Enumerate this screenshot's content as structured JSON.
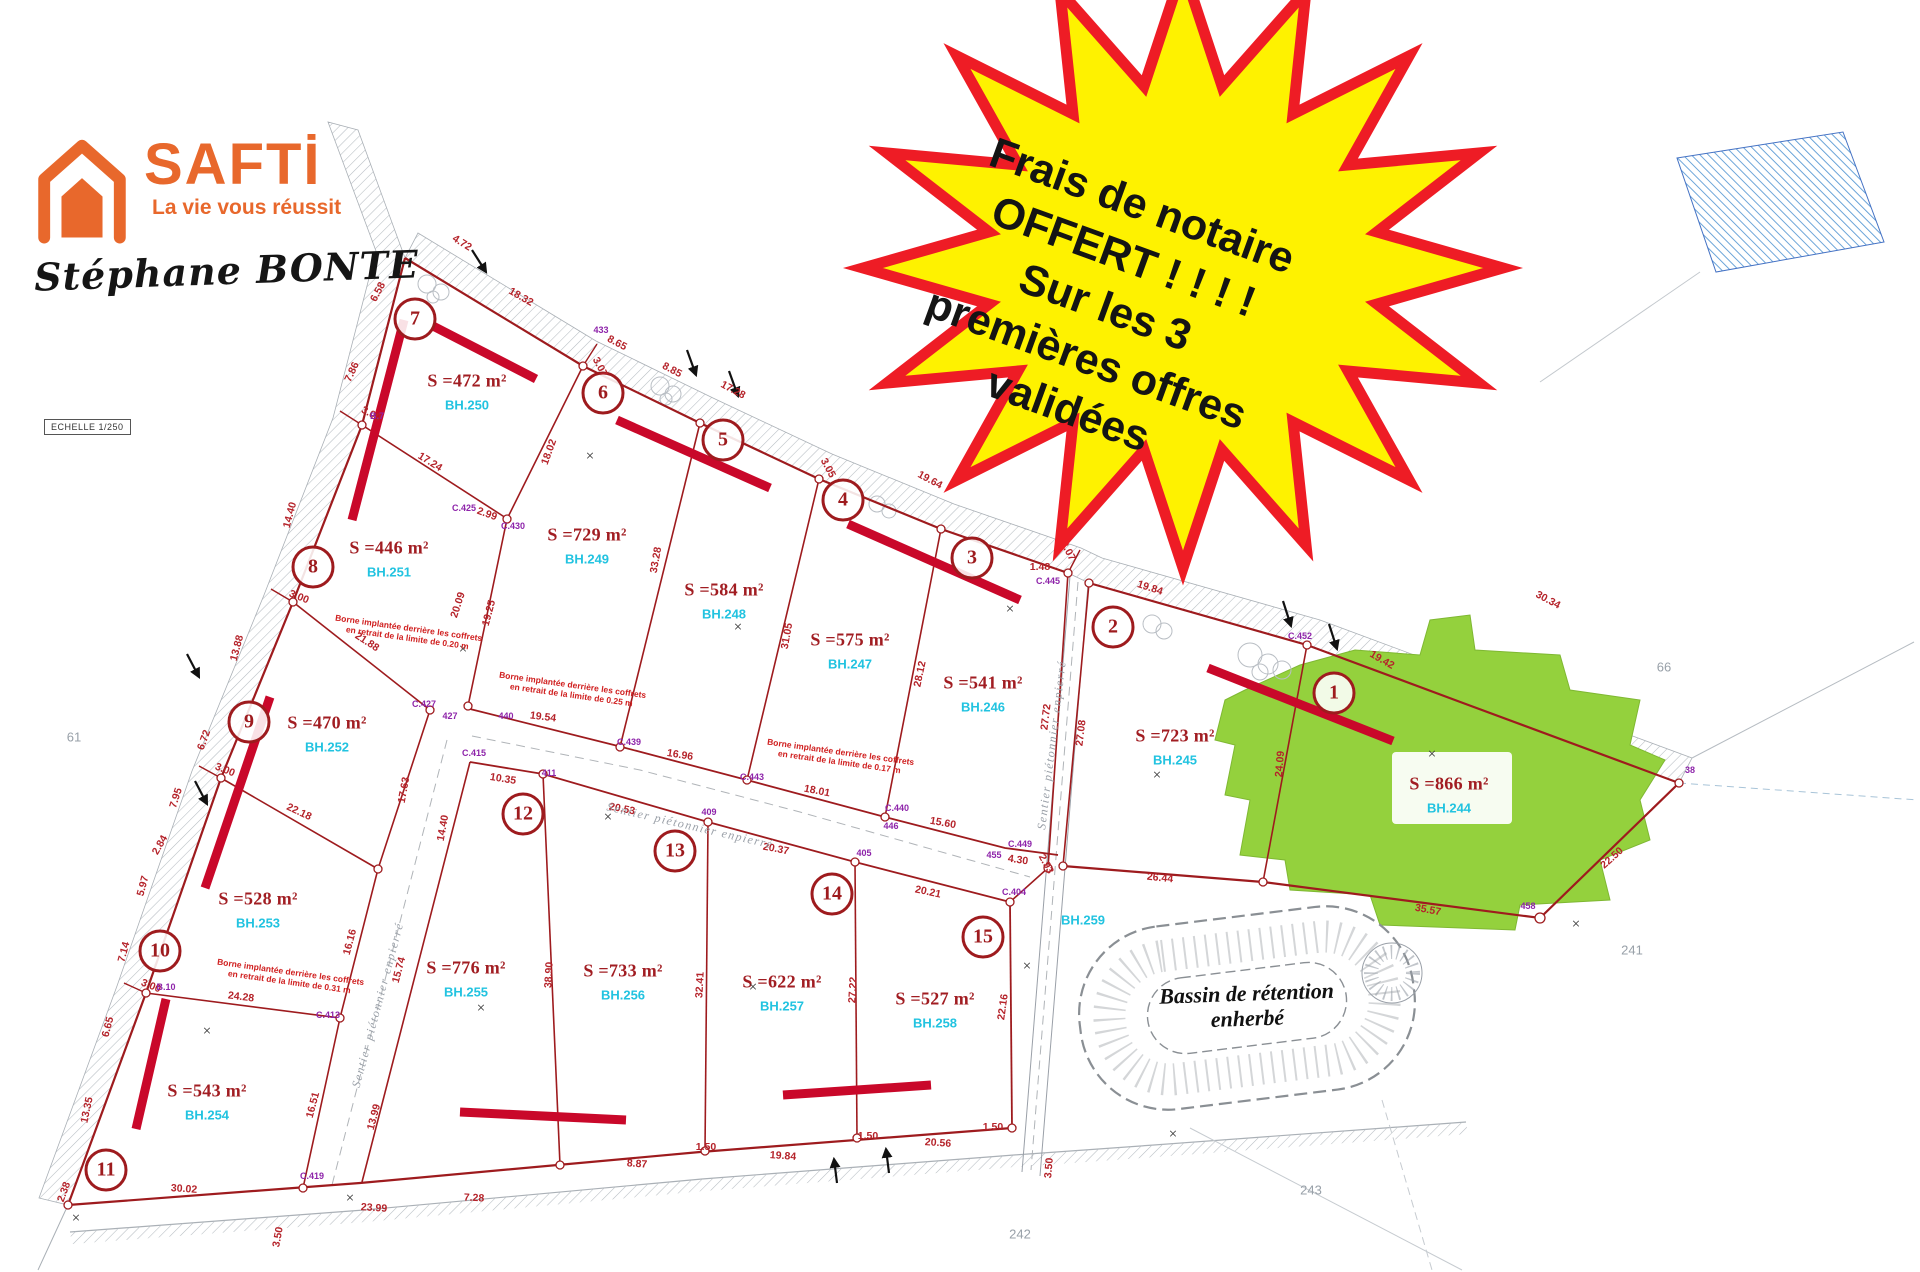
{
  "branding": {
    "name": "SAFTİ",
    "tagline": "La vie vous réussit",
    "agent": "Stéphane BONTE",
    "accent_color": "#e8682c"
  },
  "scale_label": "ECHELLE 1/250",
  "starburst": {
    "fill": "#fef200",
    "border_color": "#ee1c25",
    "text_color": "#141414",
    "lines": [
      "Frais de notaire",
      "OFFERT ! ! ! !",
      "Sur les 3",
      "premières offres",
      "validées"
    ]
  },
  "bassin": {
    "line1": "Bassin de rétention",
    "line2": "enherbé"
  },
  "plan": {
    "colors": {
      "boundary": "#9e1b1e",
      "setback_bar": "#c9082a",
      "area_text": "#a11d22",
      "code_text": "#22c3e0",
      "measure_text": "#b5232a",
      "point_text": "#8e24aa",
      "green_lot": "#94d13d",
      "road_grey": "#aab0b6",
      "blue_hatch": "#5b9bd5"
    },
    "lots": [
      {
        "number": "1",
        "area": "S =866 m²",
        "code": "BH.244",
        "badge": {
          "x": 1334,
          "y": 693
        },
        "label": {
          "x": 1449,
          "y": 784
        }
      },
      {
        "number": "2",
        "area": "S =723 m²",
        "code": "BH.245",
        "badge": {
          "x": 1113,
          "y": 627
        },
        "label": {
          "x": 1175,
          "y": 736
        }
      },
      {
        "number": "3",
        "area": "S =541 m²",
        "code": "BH.246",
        "badge": {
          "x": 972,
          "y": 558
        },
        "label": {
          "x": 983,
          "y": 683
        }
      },
      {
        "number": "4",
        "area": "S =575 m²",
        "code": "BH.247",
        "badge": {
          "x": 843,
          "y": 500
        },
        "label": {
          "x": 850,
          "y": 640
        }
      },
      {
        "number": "5",
        "area": "S =584 m²",
        "code": "BH.248",
        "badge": {
          "x": 723,
          "y": 440
        },
        "label": {
          "x": 724,
          "y": 590
        }
      },
      {
        "number": "6",
        "area": "S =729 m²",
        "code": "BH.249",
        "badge": {
          "x": 603,
          "y": 393
        },
        "label": {
          "x": 587,
          "y": 535
        }
      },
      {
        "number": "7",
        "area": "S =472 m²",
        "code": "BH.250",
        "badge": {
          "x": 415,
          "y": 319
        },
        "label": {
          "x": 467,
          "y": 381
        }
      },
      {
        "number": "8",
        "area": "S =446 m²",
        "code": "BH.251",
        "badge": {
          "x": 313,
          "y": 567
        },
        "label": {
          "x": 389,
          "y": 548
        }
      },
      {
        "number": "9",
        "area": "S =470 m²",
        "code": "BH.252",
        "badge": {
          "x": 249,
          "y": 722
        },
        "label": {
          "x": 327,
          "y": 723
        }
      },
      {
        "number": "10",
        "area": "S =528 m²",
        "code": "BH.253",
        "badge": {
          "x": 160,
          "y": 951
        },
        "label": {
          "x": 258,
          "y": 899
        }
      },
      {
        "number": "11",
        "area": "S =543 m²",
        "code": "BH.254",
        "badge": {
          "x": 106,
          "y": 1170
        },
        "label": {
          "x": 207,
          "y": 1091
        }
      },
      {
        "number": "12",
        "area": "S =776 m²",
        "code": "BH.255",
        "badge": {
          "x": 523,
          "y": 814
        },
        "label": {
          "x": 466,
          "y": 968
        }
      },
      {
        "number": "13",
        "area": "S =733 m²",
        "code": "BH.256",
        "badge": {
          "x": 675,
          "y": 851
        },
        "label": {
          "x": 623,
          "y": 971
        }
      },
      {
        "number": "14",
        "area": "S =622 m²",
        "code": "BH.257",
        "badge": {
          "x": 832,
          "y": 894
        },
        "label": {
          "x": 782,
          "y": 982
        }
      },
      {
        "number": "15",
        "area": "S =527 m²",
        "code": "BH.258",
        "badge": {
          "x": 983,
          "y": 937
        },
        "label": {
          "x": 935,
          "y": 999
        }
      }
    ],
    "extra_codes": [
      {
        "t": "BH.259",
        "x": 1083,
        "y": 920
      }
    ],
    "measurements": [
      {
        "t": "4.72",
        "x": 462,
        "y": 243,
        "r": 32
      },
      {
        "t": "18.32",
        "x": 521,
        "y": 297,
        "r": 30
      },
      {
        "t": "3.07",
        "x": 600,
        "y": 367,
        "r": 62
      },
      {
        "t": "8.65",
        "x": 617,
        "y": 343,
        "r": 28
      },
      {
        "t": "8.85",
        "x": 672,
        "y": 370,
        "r": 28
      },
      {
        "t": "17.28",
        "x": 733,
        "y": 390,
        "r": 28
      },
      {
        "t": "3.05",
        "x": 828,
        "y": 468,
        "r": 62
      },
      {
        "t": "19.64",
        "x": 930,
        "y": 480,
        "r": 28
      },
      {
        "t": "1.48",
        "x": 1040,
        "y": 567,
        "r": 0
      },
      {
        "t": "3.07",
        "x": 1068,
        "y": 551,
        "r": 62
      },
      {
        "t": "19.84",
        "x": 1150,
        "y": 588,
        "r": 18
      },
      {
        "t": "19.42",
        "x": 1382,
        "y": 660,
        "r": 30
      },
      {
        "t": "30.34",
        "x": 1548,
        "y": 600,
        "r": 28
      },
      {
        "t": "22.50",
        "x": 1612,
        "y": 858,
        "r": -42
      },
      {
        "t": "35.57",
        "x": 1428,
        "y": 910,
        "r": 10
      },
      {
        "t": "26.44",
        "x": 1160,
        "y": 878,
        "r": 6
      },
      {
        "t": "4.30",
        "x": 1018,
        "y": 860,
        "r": 8
      },
      {
        "t": "2.93",
        "x": 1046,
        "y": 864,
        "r": 62
      },
      {
        "t": "24.09",
        "x": 1280,
        "y": 764,
        "r": -85
      },
      {
        "t": "27.08",
        "x": 1081,
        "y": 733,
        "r": -83
      },
      {
        "t": "27.72",
        "x": 1046,
        "y": 717,
        "r": -83
      },
      {
        "t": "28.12",
        "x": 920,
        "y": 674,
        "r": -78
      },
      {
        "t": "31.05",
        "x": 787,
        "y": 636,
        "r": -80
      },
      {
        "t": "33.28",
        "x": 656,
        "y": 560,
        "r": -80
      },
      {
        "t": "18.02",
        "x": 549,
        "y": 452,
        "r": -70
      },
      {
        "t": "19.25",
        "x": 489,
        "y": 613,
        "r": -75
      },
      {
        "t": "17.24",
        "x": 430,
        "y": 462,
        "r": 32
      },
      {
        "t": "20.09",
        "x": 458,
        "y": 605,
        "r": -72
      },
      {
        "t": "21.88",
        "x": 367,
        "y": 642,
        "r": 33
      },
      {
        "t": "14.40",
        "x": 290,
        "y": 515,
        "r": -75
      },
      {
        "t": "13.88",
        "x": 237,
        "y": 648,
        "r": -75
      },
      {
        "t": "22.18",
        "x": 299,
        "y": 812,
        "r": 25
      },
      {
        "t": "17.63",
        "x": 404,
        "y": 790,
        "r": -80
      },
      {
        "t": "14.40",
        "x": 443,
        "y": 828,
        "r": -80
      },
      {
        "t": "6.58",
        "x": 378,
        "y": 292,
        "r": -62
      },
      {
        "t": "7.86",
        "x": 352,
        "y": 372,
        "r": -65
      },
      {
        "t": "6.72",
        "x": 204,
        "y": 740,
        "r": -70
      },
      {
        "t": "3.00",
        "x": 371,
        "y": 414,
        "r": 28
      },
      {
        "t": "3.00",
        "x": 299,
        "y": 597,
        "r": 22
      },
      {
        "t": "3.00",
        "x": 225,
        "y": 770,
        "r": 22
      },
      {
        "t": "3.00",
        "x": 151,
        "y": 986,
        "r": 22
      },
      {
        "t": "7.95",
        "x": 176,
        "y": 798,
        "r": -72
      },
      {
        "t": "2.84",
        "x": 160,
        "y": 845,
        "r": -60
      },
      {
        "t": "5.97",
        "x": 143,
        "y": 886,
        "r": -75
      },
      {
        "t": "7.14",
        "x": 124,
        "y": 952,
        "r": -75
      },
      {
        "t": "6.65",
        "x": 108,
        "y": 1027,
        "r": -75
      },
      {
        "t": "13.35",
        "x": 87,
        "y": 1110,
        "r": -78
      },
      {
        "t": "2.38",
        "x": 64,
        "y": 1192,
        "r": -70
      },
      {
        "t": "24.28",
        "x": 241,
        "y": 997,
        "r": 7
      },
      {
        "t": "16.16",
        "x": 350,
        "y": 942,
        "r": -75
      },
      {
        "t": "15.74",
        "x": 399,
        "y": 970,
        "r": -75
      },
      {
        "t": "16.51",
        "x": 313,
        "y": 1105,
        "r": -75
      },
      {
        "t": "13.99",
        "x": 374,
        "y": 1117,
        "r": -75
      },
      {
        "t": "30.02",
        "x": 184,
        "y": 1189,
        "r": 4
      },
      {
        "t": "23.99",
        "x": 374,
        "y": 1208,
        "r": 4
      },
      {
        "t": "7.28",
        "x": 474,
        "y": 1198,
        "r": 3
      },
      {
        "t": "8.87",
        "x": 637,
        "y": 1164,
        "r": 4
      },
      {
        "t": "1.50",
        "x": 706,
        "y": 1147,
        "r": 0
      },
      {
        "t": "19.84",
        "x": 783,
        "y": 1156,
        "r": 4
      },
      {
        "t": "1.50",
        "x": 868,
        "y": 1136,
        "r": 0
      },
      {
        "t": "20.56",
        "x": 938,
        "y": 1143,
        "r": 4
      },
      {
        "t": "1.50",
        "x": 993,
        "y": 1127,
        "r": 0
      },
      {
        "t": "3.50",
        "x": 1049,
        "y": 1168,
        "r": -85
      },
      {
        "t": "3.50",
        "x": 278,
        "y": 1237,
        "r": -80
      },
      {
        "t": "38.90",
        "x": 549,
        "y": 975,
        "r": -87
      },
      {
        "t": "32.41",
        "x": 700,
        "y": 985,
        "r": -87
      },
      {
        "t": "27.22",
        "x": 853,
        "y": 990,
        "r": -87
      },
      {
        "t": "22.16",
        "x": 1003,
        "y": 1007,
        "r": -82
      },
      {
        "t": "20.21",
        "x": 928,
        "y": 892,
        "r": 12
      },
      {
        "t": "15.60",
        "x": 943,
        "y": 823,
        "r": 10
      },
      {
        "t": "18.01",
        "x": 817,
        "y": 791,
        "r": 11
      },
      {
        "t": "16.96",
        "x": 680,
        "y": 755,
        "r": 9
      },
      {
        "t": "19.54",
        "x": 543,
        "y": 717,
        "r": 7
      },
      {
        "t": "10.35",
        "x": 503,
        "y": 779,
        "r": 9
      },
      {
        "t": "20.53",
        "x": 622,
        "y": 809,
        "r": 11
      },
      {
        "t": "20.37",
        "x": 776,
        "y": 849,
        "r": 11
      },
      {
        "t": "2.99",
        "x": 487,
        "y": 514,
        "r": 20
      }
    ],
    "point_labels": [
      {
        "t": "C.427",
        "x": 424,
        "y": 704
      },
      {
        "t": "427",
        "x": 450,
        "y": 716
      },
      {
        "t": "440",
        "x": 506,
        "y": 716
      },
      {
        "t": "C.415",
        "x": 474,
        "y": 753
      },
      {
        "t": "411",
        "x": 549,
        "y": 773
      },
      {
        "t": "C.439",
        "x": 629,
        "y": 742
      },
      {
        "t": "C.443",
        "x": 752,
        "y": 777
      },
      {
        "t": "409",
        "x": 709,
        "y": 812
      },
      {
        "t": "C.440",
        "x": 897,
        "y": 808
      },
      {
        "t": "446",
        "x": 891,
        "y": 826
      },
      {
        "t": "405",
        "x": 864,
        "y": 853
      },
      {
        "t": "C.449",
        "x": 1020,
        "y": 844
      },
      {
        "t": "455",
        "x": 994,
        "y": 855
      },
      {
        "t": "C.404",
        "x": 1014,
        "y": 892
      },
      {
        "t": "C.452",
        "x": 1300,
        "y": 636
      },
      {
        "t": "C.445",
        "x": 1048,
        "y": 581
      },
      {
        "t": "433",
        "x": 601,
        "y": 330
      },
      {
        "t": "C.430",
        "x": 513,
        "y": 526
      },
      {
        "t": "C.425",
        "x": 464,
        "y": 508
      },
      {
        "t": "C.413",
        "x": 328,
        "y": 1015
      },
      {
        "t": "C.419",
        "x": 312,
        "y": 1176
      },
      {
        "t": "B.7",
        "x": 377,
        "y": 416
      },
      {
        "t": "B.10",
        "x": 166,
        "y": 987
      },
      {
        "t": "458",
        "x": 1528,
        "y": 906
      },
      {
        "t": "38",
        "x": 1690,
        "y": 770
      }
    ],
    "notes": [
      {
        "l1": "Borne implantée derrière les coffrets",
        "l2": "en retrait de la limite de 0.20 m",
        "x": 408,
        "y": 633,
        "r": 8
      },
      {
        "l1": "Borne implantée derrière les coffrets",
        "l2": "en retrait de la limite de 0.25 m",
        "x": 572,
        "y": 690,
        "r": 8
      },
      {
        "l1": "Borne implantée derrière les coffrets",
        "l2": "en retrait de la limite de 0.17 m",
        "x": 840,
        "y": 757,
        "r": 8
      },
      {
        "l1": "Borne implantée derrière les coffrets",
        "l2": "en retrait de la limite de 0.31 m",
        "x": 290,
        "y": 977,
        "r": 8
      }
    ],
    "path_labels": [
      {
        "t": "Sentier piétonnier enpierré",
        "x": 690,
        "y": 826,
        "r": 13
      },
      {
        "t": "Sentier piétonnier enpierré",
        "x": 1052,
        "y": 745,
        "r": -83
      },
      {
        "t": "Sentier piétonnier enpierré",
        "x": 378,
        "y": 1005,
        "r": -75
      }
    ],
    "x_marks": [
      {
        "x": 590,
        "y": 457
      },
      {
        "x": 738,
        "y": 628
      },
      {
        "x": 1010,
        "y": 610
      },
      {
        "x": 1157,
        "y": 776
      },
      {
        "x": 1432,
        "y": 755
      },
      {
        "x": 463,
        "y": 650
      },
      {
        "x": 207,
        "y": 1032
      },
      {
        "x": 481,
        "y": 1009
      },
      {
        "x": 608,
        "y": 818
      },
      {
        "x": 753,
        "y": 988
      },
      {
        "x": 1027,
        "y": 967
      },
      {
        "x": 1173,
        "y": 1135
      },
      {
        "x": 1576,
        "y": 925
      },
      {
        "x": 350,
        "y": 1199
      },
      {
        "x": 76,
        "y": 1219
      }
    ],
    "parcel_numbers": [
      {
        "t": "61",
        "x": 74,
        "y": 737
      },
      {
        "t": "66",
        "x": 1664,
        "y": 667
      },
      {
        "t": "241",
        "x": 1632,
        "y": 950
      },
      {
        "t": "242",
        "x": 1020,
        "y": 1234
      },
      {
        "t": "243",
        "x": 1311,
        "y": 1190
      }
    ]
  }
}
